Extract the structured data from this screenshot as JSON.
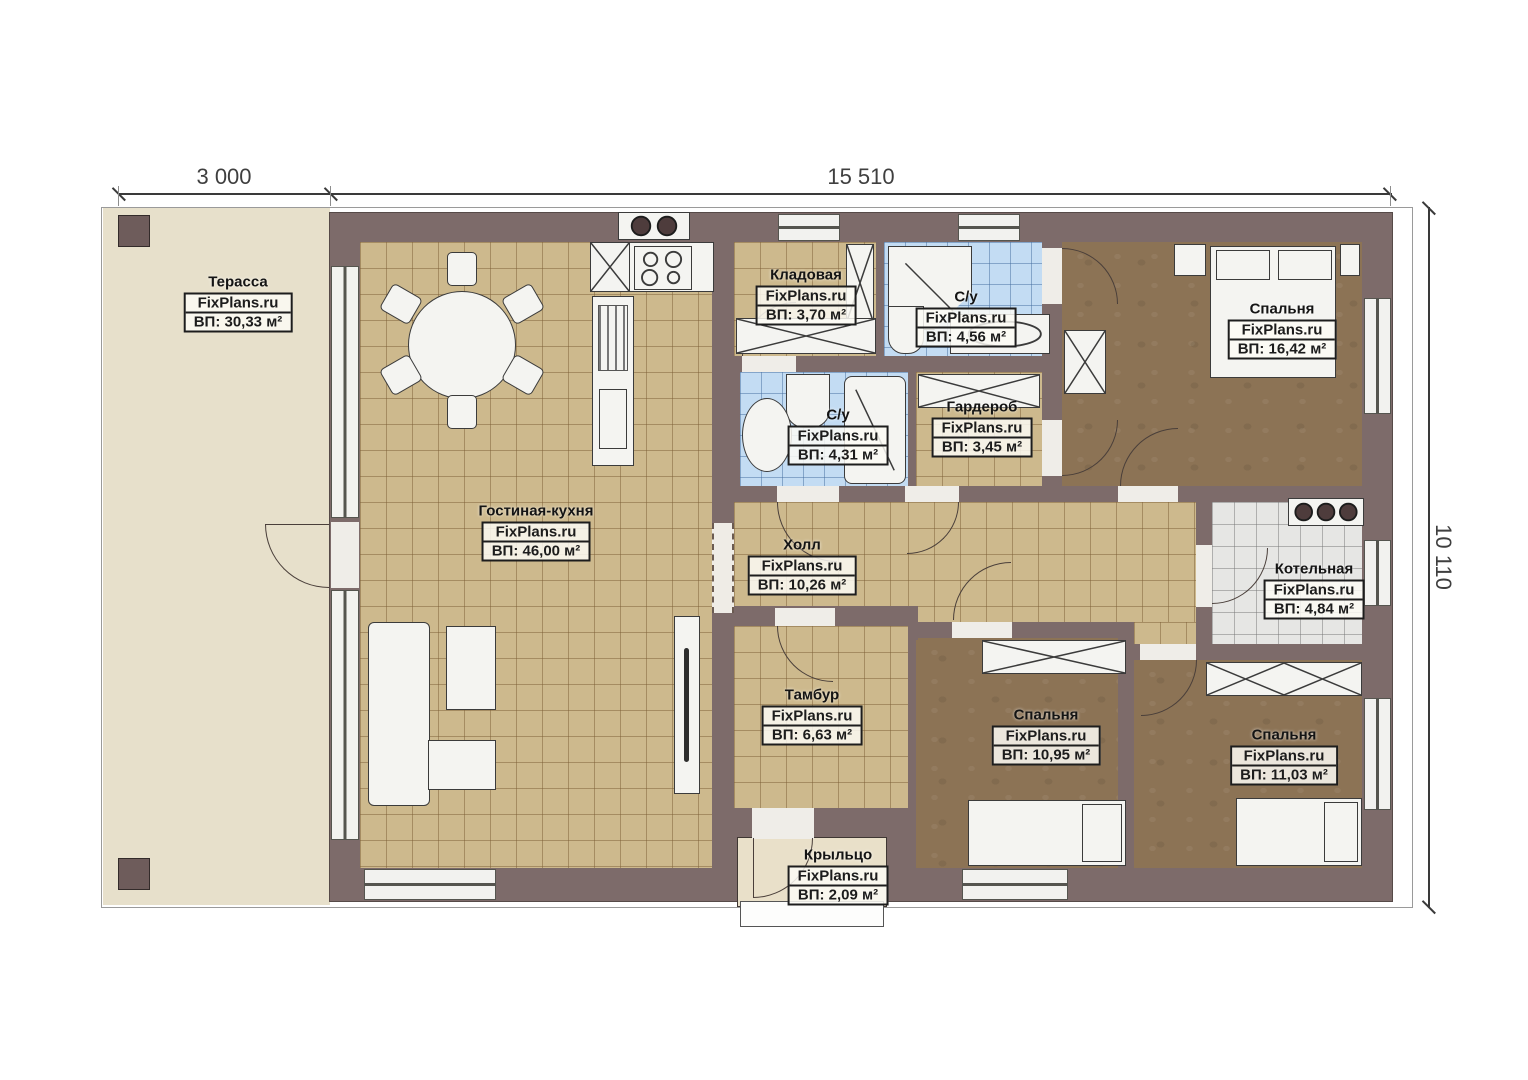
{
  "plan": {
    "brand": "FixPlans.ru",
    "type": "single-storey house floor plan"
  },
  "dimensions": {
    "terrace_width": "3 000",
    "house_width": "15 510",
    "house_height": "10 110"
  },
  "rooms": [
    {
      "name": "Терасса",
      "brand": "FixPlans.ru",
      "area": "ВП: 30,33 м²"
    },
    {
      "name": "Гостиная-кухня",
      "brand": "FixPlans.ru",
      "area": "ВП: 46,00 м²"
    },
    {
      "name": "Кладовая",
      "brand": "FixPlans.ru",
      "area": "ВП: 3,70 м²"
    },
    {
      "name": "С/у",
      "brand": "FixPlans.ru",
      "area": "ВП: 4,56 м²"
    },
    {
      "name": "С/у",
      "brand": "FixPlans.ru",
      "area": "ВП: 4,31 м²"
    },
    {
      "name": "Гардероб",
      "brand": "FixPlans.ru",
      "area": "ВП: 3,45 м²"
    },
    {
      "name": "Спальня",
      "brand": "FixPlans.ru",
      "area": "ВП: 16,42 м²"
    },
    {
      "name": "Котельная",
      "brand": "FixPlans.ru",
      "area": "ВП: 4,84 м²"
    },
    {
      "name": "Холл",
      "brand": "FixPlans.ru",
      "area": "ВП: 10,26 м²"
    },
    {
      "name": "Тамбур",
      "brand": "FixPlans.ru",
      "area": "ВП: 6,63 м²"
    },
    {
      "name": "Спальня",
      "brand": "FixPlans.ru",
      "area": "ВП: 10,95 м²"
    },
    {
      "name": "Спальня",
      "brand": "FixPlans.ru",
      "area": "ВП: 11,03 м²"
    },
    {
      "name": "Крыльцо",
      "brand": "FixPlans.ru",
      "area": "ВП: 2,09 м²"
    }
  ],
  "colors": {
    "wall": "#7d6b6a",
    "tile_tan": "#cdb98d",
    "tile_blue": "#c3dcf3",
    "floor_brown": "#8c7355",
    "terrace": "#e7e0cb",
    "boiler_tile": "#e6e6e4"
  }
}
